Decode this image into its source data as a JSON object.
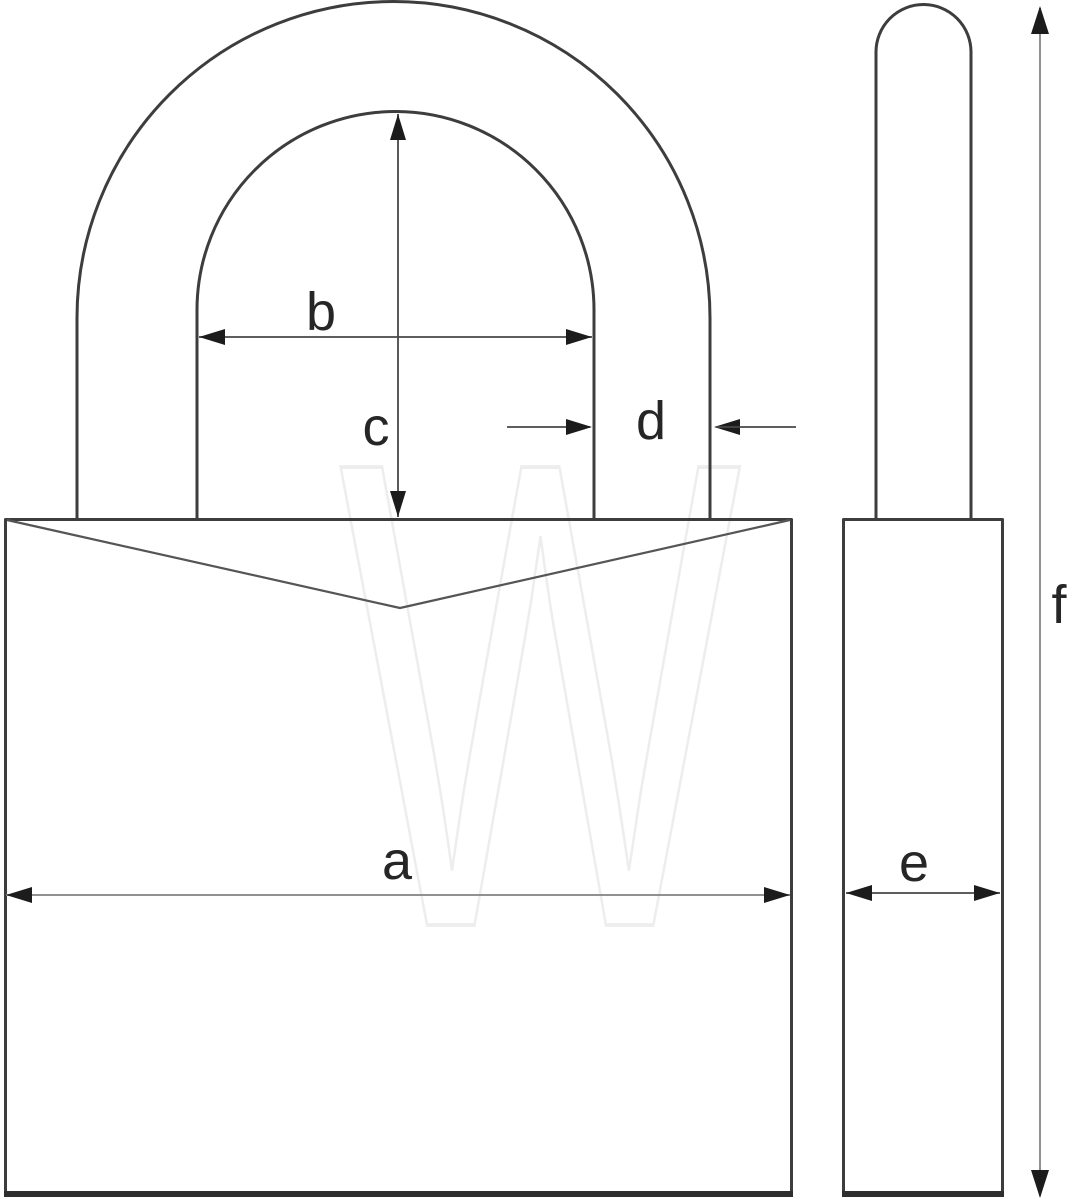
{
  "diagram": {
    "dimension_labels": {
      "a": "a",
      "b": "b",
      "c": "c",
      "d": "d",
      "e": "e",
      "f": "f"
    },
    "watermark_text": "W",
    "colors": {
      "background": "#ffffff",
      "outline": "#3d3d3d",
      "dimension_line": "#474747",
      "long_dimension_line": "#919191",
      "arrowhead": "#1c1c1c",
      "label": "#262626",
      "watermark": "#ededed"
    }
  }
}
